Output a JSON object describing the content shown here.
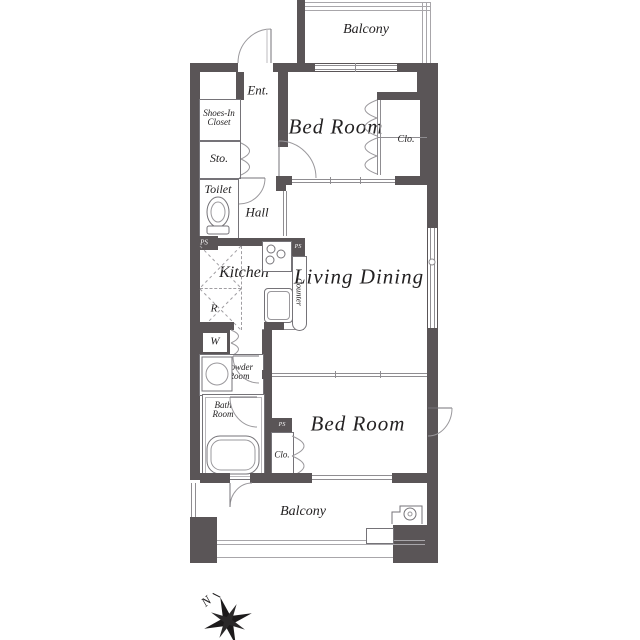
{
  "colors": {
    "wall": "#5a5557",
    "thin_line": "#8f8d91",
    "railing": "#a8a6aa",
    "text": "#232122",
    "ps_text": "#ffffff"
  },
  "rooms": {
    "balcony_top": "Balcony",
    "entrance": "Ent.",
    "shoes_closet": [
      "Shoes-In",
      "Closet"
    ],
    "storage": "Sto.",
    "toilet": "Toilet",
    "hall": "Hall",
    "bedroom_top": "Bed Room",
    "closet_top": "Clo.",
    "kitchen": "Kitchen",
    "counter": "Counter",
    "living_dining": "Living Dining",
    "refrigerator": "R",
    "washer": "W",
    "powder_room": [
      "Powder",
      "Room"
    ],
    "bath_room": [
      "Bath",
      "Room"
    ],
    "closet_bottom": "Clo.",
    "bedroom_bottom": "Bed Room",
    "balcony_bottom": "Balcony",
    "pipe_space": "PS",
    "compass_north": "N"
  }
}
